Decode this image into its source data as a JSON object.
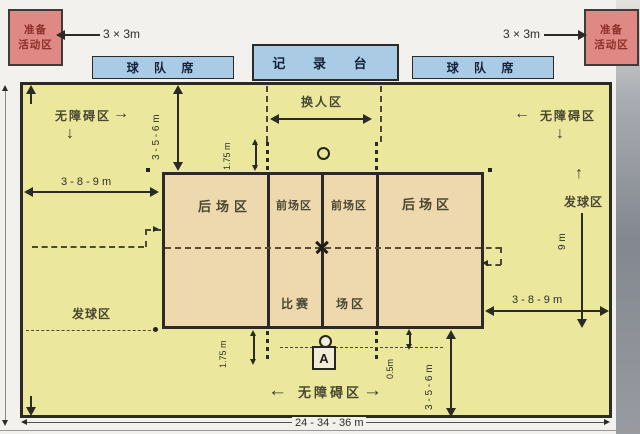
{
  "colors": {
    "free_zone": "#ebe89e",
    "court": "#eed9ae",
    "bench_blue": "#a9cbe5",
    "prep_red": "#e08883",
    "line_dark": "#2b2a24",
    "label_olive": "#4a4632"
  },
  "top": {
    "prep_left_line1": "准备",
    "prep_left_line2": "活动区",
    "prep_right_line1": "准备",
    "prep_right_line2": "活动区",
    "size_left": "3 × 3m",
    "size_right": "3 × 3m",
    "bench_left": "球 队 席",
    "bench_right": "球 队 席",
    "recorder": "记 录 台"
  },
  "zones": {
    "free_left": "无障碍区",
    "free_right": "无障碍区",
    "free_bottom": "无障碍区",
    "substitution": "换人区",
    "service_left": "发球区",
    "service_right": "发球区",
    "back_left": "后场区",
    "front_left": "前场区",
    "front_right": "前场区",
    "back_right": "后场区",
    "court_label_1": "比赛",
    "court_label_2": "场区"
  },
  "dims": {
    "w_389_left": "3 - 8 - 9 m",
    "w_389_right": "3 - 8 - 9 m",
    "h_356_top": "3 - 5 - 6 m",
    "h_356_bottom": "3 - 5 - 6 m",
    "h_175_top": "1.75 m",
    "h_175_bottom": "1.75 m",
    "court_width": "9 m",
    "d_05": "0.5m",
    "total_height": "15 - 19 - 21 m",
    "total_width": "24 - 34 - 36 m"
  },
  "icons": {
    "arrow_left": "←",
    "arrow_right": "→",
    "arrow_up": "↑",
    "arrow_down": "↓"
  },
  "markers": {
    "referee_chair": "A"
  }
}
